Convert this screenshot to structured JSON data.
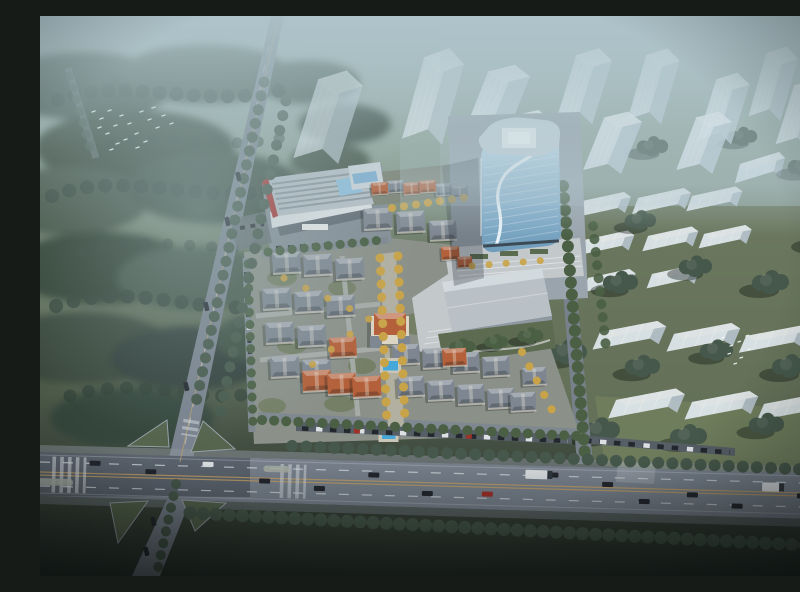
{
  "meta": {
    "type": "architectural-aerial-rendering",
    "description": "Bird's-eye 3D architectural rendering of a mixed-use development: a curved blue-glass office tower and striped-roof retail mall beside clusters of low-rise European-style villas with slate and terracotta roofs, golden autumn trees, two small swimming pools and a paved plaza; translucent white massing towers and low slab blocks stand in misty woodland to the north and east; a tree-lined avenue with lane markings, cars and trucks crosses the foreground, meeting a diagonal road at a landscaped intersection; a flock of white birds flies over the dark forest at upper left."
  },
  "scene": {
    "setting": "hazy daylight over woodland and fields",
    "camera": "high-angle aerial view",
    "elements": [
      {
        "name": "ghost-massing-towers",
        "count": 11,
        "note": "translucent white high-rise volumes in mist, upper right"
      },
      {
        "name": "slab-blocks",
        "count": 13,
        "note": "low translucent residential slabs, east field"
      },
      {
        "name": "glass-office-tower",
        "count": 1,
        "note": "rounded blue curtain-wall tower with white swoosh band and roof skylight"
      },
      {
        "name": "retail-mall",
        "count": 1,
        "note": "low commercial block, striped skylight roof, red west edge, glass atrium"
      },
      {
        "name": "exhibition-hall",
        "count": 1,
        "note": "large flat pale-gray hall south of the tower plaza"
      },
      {
        "name": "villas",
        "count": 34,
        "note": "slate-gray and terracotta roofed low-rise houses with cream walls"
      },
      {
        "name": "chateau-clubhouse",
        "count": 1,
        "note": "central landmark with orange hip roof"
      },
      {
        "name": "swimming-pools",
        "count": 2
      },
      {
        "name": "main-avenue",
        "count": 1,
        "note": "wide road across foreground with dashed lanes, crosswalks, cars and trucks"
      },
      {
        "name": "diagonal-road",
        "count": 1,
        "note": "runs from top center to bottom left through an X intersection with green islands"
      },
      {
        "name": "bird-flocks",
        "count": 2,
        "note": "white birds over forest (upper left) and field (right)"
      },
      {
        "name": "forest",
        "count": 1,
        "note": "dark misty tree masses, left half and borders"
      }
    ],
    "vehicles": {
      "cars_on_avenue": 14,
      "trucks": 2,
      "parked_cars_rows": 4
    }
  },
  "palette": {
    "mist": "#aabfc5",
    "forest_dark": "#33433a",
    "forest_mid": "#46584b",
    "field_green": "#68765c",
    "road_asphalt": "#79828e",
    "lane_yellow": "#c7a366",
    "lane_white": "#d5dbe0",
    "island_green": "#55644d",
    "ghost_tower": "#e6eef5",
    "glass_light": "#cfe6f4",
    "glass_dark": "#6f9cba",
    "tower_roof": "#c6d4dc",
    "mall_roof": "#b7c0c7",
    "mall_red": "#a83430",
    "mall_glass": "#8fc0de",
    "hall_gray": "#b9c1c7",
    "villa_gray": "#7e8791",
    "villa_orange": "#b4603a",
    "autumn_tree": "#c9a348",
    "site_tree": "#4a5f44",
    "pool_blue": "#45a8d8",
    "plaza": "#c3c8cb",
    "promenade": "#b2b0a1",
    "parking": "#565e66",
    "car_dark": "#23272e",
    "car_white": "#dde1e4",
    "car_red": "#a03028",
    "bird_white": "#f2f5f3"
  }
}
